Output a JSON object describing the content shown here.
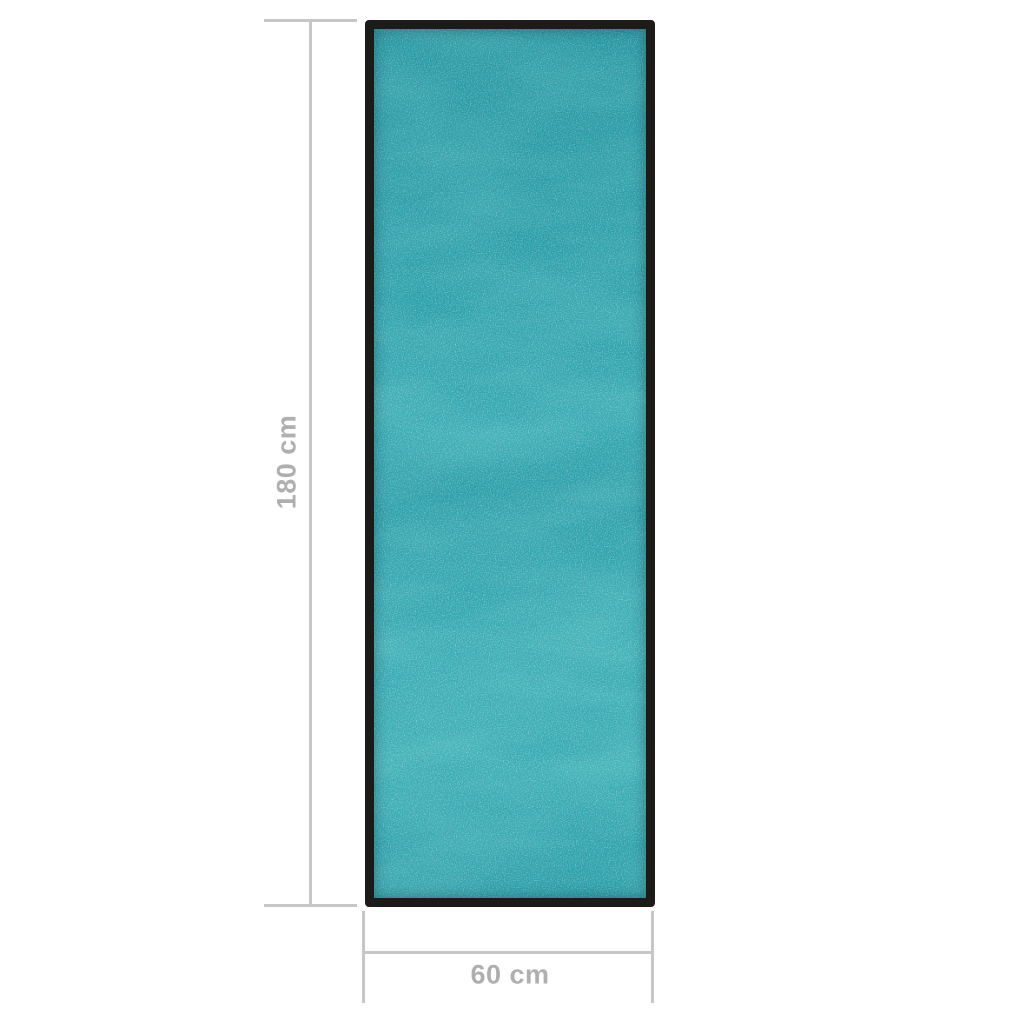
{
  "diagram": {
    "height_dimension": {
      "label": "180 cm"
    },
    "width_dimension": {
      "label": "60 cm"
    }
  },
  "colors": {
    "background": "#ffffff",
    "dimension_line": "#c6c6c6",
    "dimension_text": "#afafaf",
    "mat_border": "#1d1b17",
    "mat_base": "#2aa0a9",
    "mat_speckle_dark": "#0a616f",
    "mat_speckle_light": "#73d9d6"
  }
}
